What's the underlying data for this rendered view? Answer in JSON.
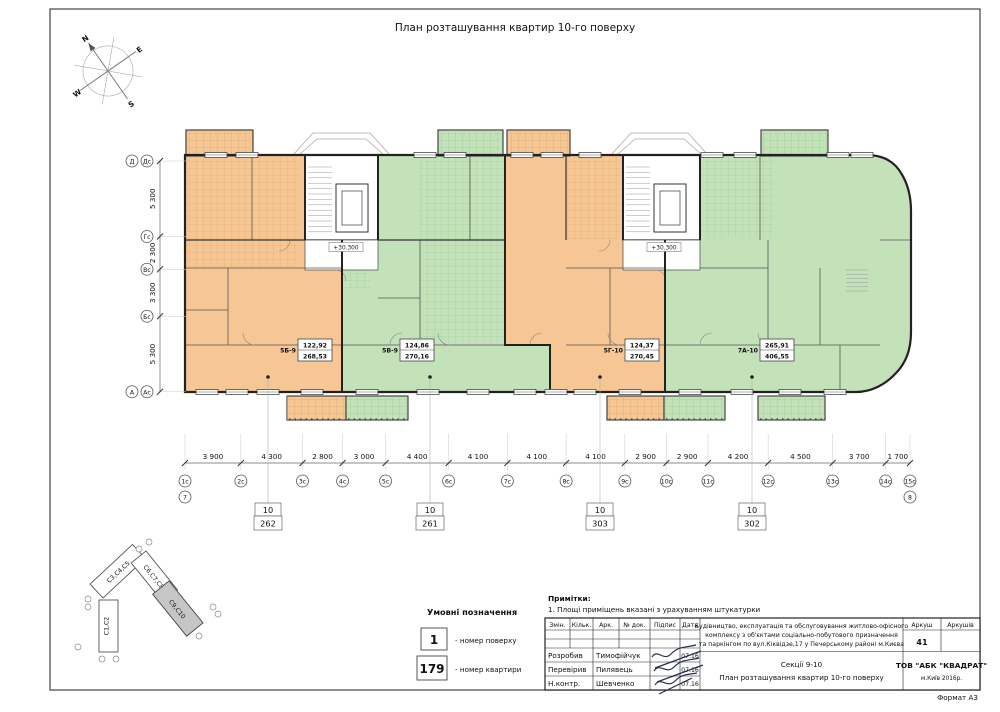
{
  "page": {
    "title": "План розташування квартир 10-го поверху",
    "format_label": "Формат А3"
  },
  "compass": {
    "n": "N",
    "e": "E",
    "s": "S",
    "w": "W"
  },
  "plan": {
    "elevation_mark": "+30.300",
    "apartments": [
      {
        "id": "5Б-9",
        "area_living": "122,92",
        "area_total": "268,53",
        "callout_floor": "10",
        "callout_number": "262"
      },
      {
        "id": "5В-9",
        "area_living": "124,86",
        "area_total": "270,16",
        "callout_floor": "10",
        "callout_number": "261"
      },
      {
        "id": "5Г-10",
        "area_living": "124,37",
        "area_total": "270,45",
        "callout_floor": "10",
        "callout_number": "303"
      },
      {
        "id": "7А-10",
        "area_living": "265,91",
        "area_total": "406,55",
        "callout_floor": "10",
        "callout_number": "302"
      }
    ]
  },
  "dimensions": {
    "horizontal": {
      "values": [
        "3 900",
        "4 300",
        "2 800",
        "3 000",
        "4 400",
        "4 100",
        "4 100",
        "4 100",
        "2 900",
        "2 900",
        "4 200",
        "4 500",
        "3 700",
        "1 700"
      ],
      "axes": [
        "1с",
        "2с",
        "3с",
        "4с",
        "5с",
        "6с",
        "7с",
        "8с",
        "9с",
        "10с",
        "11с",
        "12с",
        "13с",
        "14с",
        "15с"
      ],
      "below_first": "7",
      "below_last": "8"
    },
    "vertical": {
      "values": [
        "5 300",
        "2 300",
        "3 300",
        "5 300"
      ],
      "axes": [
        [
          "Д",
          "Дс"
        ],
        [
          "Гс"
        ],
        [
          "Вс"
        ],
        [
          "Бс"
        ],
        [
          "А",
          "Ас"
        ]
      ]
    }
  },
  "legend": {
    "title": "Умовні позначення",
    "items": [
      {
        "symbol": "1",
        "label": "- номер поверху"
      },
      {
        "symbol": "179",
        "label": "- номер квартири"
      }
    ]
  },
  "notes": {
    "title": "Примітки:",
    "line1": "1. Площі приміщень вказані з урахуванням штукатурки"
  },
  "site_key": {
    "sections": [
      {
        "label": "С1,С2"
      },
      {
        "label": "С3,С4,С5"
      },
      {
        "label": "С6,С7,С8"
      },
      {
        "label": "С9,С10",
        "highlighted": true
      }
    ]
  },
  "title_block": {
    "headers": [
      "Змін.",
      "Кільк.",
      "Арк.",
      "№ док.",
      "Підпис",
      "Дата"
    ],
    "rows": [
      {
        "role": "Розробив",
        "name": "Тимофійчук",
        "date": "07.16"
      },
      {
        "role": "Перевірив",
        "name": "Пилявець",
        "date": "07.16"
      },
      {
        "role": "Н.контр.",
        "name": "Шевченко",
        "date": "07.16"
      }
    ],
    "project_lines": [
      "Будівництво, експлуатація та обслуговування житлово-офісного",
      "комплексу з об'єктами соціально-побутового призначення",
      "та паркінгом по вул.Кіквідзе,17 у Печерському районі м.Києва"
    ],
    "section_title": "Секції 9-10",
    "sheet_title": "План розташування квартир 10-го поверху",
    "sheet_label": "Аркуш",
    "sheets_label": "Аркушів",
    "sheet_number": "41",
    "company": "ТОВ \"АБК \"КВАДРАТ\"",
    "company_city": "м.Київ 2016р."
  },
  "colors": {
    "orange": "#f6c794",
    "green": "#c3e2ba",
    "orange_hatch": "#d89f5f",
    "green_hatch": "#8fc487",
    "wall": "#222222"
  }
}
